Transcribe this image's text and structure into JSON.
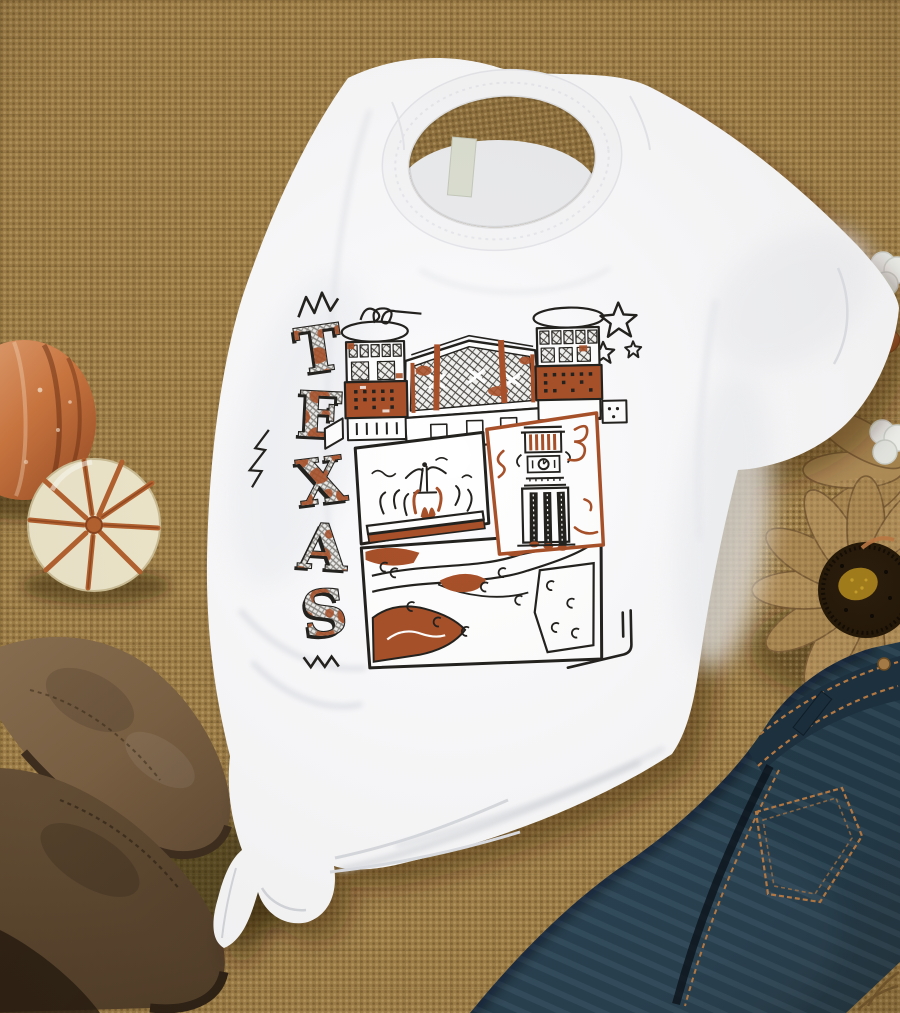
{
  "scene": {
    "kind": "flat-lay product photo",
    "shirt_text": "TEXAS"
  },
  "design": {
    "letters": [
      "T",
      "E",
      "X",
      "A",
      "S"
    ],
    "landmarks": [
      "stadium",
      "fountain",
      "clock-tower",
      "campus-pool"
    ],
    "doodles": [
      "crown-zigzag",
      "loop-squiggle",
      "stars",
      "lightning",
      "zigzag",
      "corner-lines"
    ]
  },
  "props": {
    "background": "burlap",
    "left": [
      "copper-pumpkin",
      "cream-pumpkin",
      "suede-boots"
    ],
    "right": [
      "cotton-bolls",
      "copper-acorn",
      "burlap-flower",
      "denim-jeans"
    ]
  },
  "colors": {
    "burlap": "#a08048",
    "burlap_dark": "#6b5026",
    "shirt": "#fbfbfd",
    "ink": "#24221f",
    "burnt_orange": "#a8512a",
    "denim": "#223a49",
    "denim_stitch": "#b97c45",
    "suede": "#7b6144",
    "suede_dark": "#5e4832",
    "copper": "#c06a3b",
    "cream": "#efe8cd",
    "flower_center": "#241808",
    "flower_eye": "#a57f1d",
    "label": "#dce0d2",
    "cotton": "#eef0ec"
  }
}
